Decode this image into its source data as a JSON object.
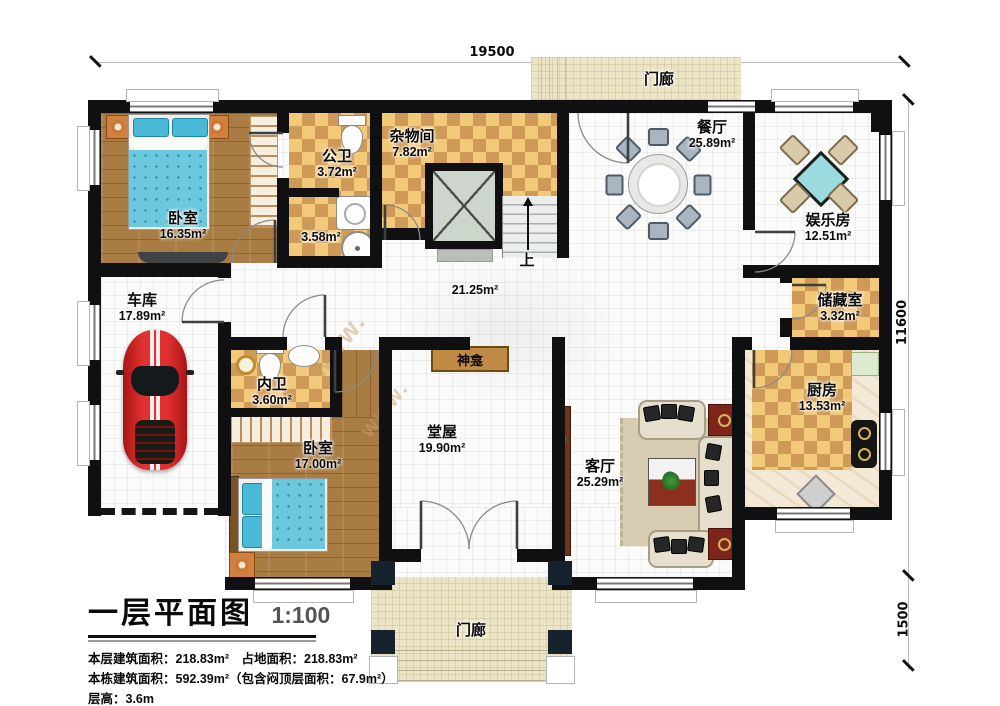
{
  "title_block": {
    "title": "一层平面图",
    "scale": "1:100",
    "info_lines": [
      "本层建筑面积：218.83m²　占地面积：218.83m²",
      "本栋建筑面积：592.39m²（包含闷顶层面积：67.9m²）",
      "层高：3.6m"
    ]
  },
  "dimensions": {
    "width": "19500",
    "height": "11600",
    "porch_depth": "1500"
  },
  "rooms": {
    "porch_top": {
      "name": "门廊"
    },
    "porch_bottom": {
      "name": "门廊"
    },
    "bedroom1": {
      "name": "卧室",
      "area": "16.35m²"
    },
    "public_bath": {
      "name": "公卫",
      "area": "3.72m²"
    },
    "bath_zone": {
      "area": "3.58m²"
    },
    "utility": {
      "name": "杂物间",
      "area": "7.82m²"
    },
    "dining": {
      "name": "餐厅",
      "area": "25.89m²"
    },
    "entertainment": {
      "name": "娱乐房",
      "area": "12.51m²"
    },
    "storage": {
      "name": "储藏室",
      "area": "3.32m²"
    },
    "kitchen": {
      "name": "厨房",
      "area": "13.53m²"
    },
    "garage": {
      "name": "车库",
      "area": "17.89m²"
    },
    "inner_bath": {
      "name": "内卫",
      "area": "3.60m²"
    },
    "bedroom2": {
      "name": "卧室",
      "area": "17.00m²"
    },
    "hall": {
      "area": "21.25m²"
    },
    "main_hall": {
      "name": "堂屋",
      "area": "19.90m²"
    },
    "living": {
      "name": "客厅",
      "area": "25.29m²"
    },
    "shrine": {
      "name": "神龛"
    },
    "stairs_up": {
      "label": "上"
    }
  },
  "watermark": {
    "text": "www."
  },
  "colors": {
    "wall": "#101012",
    "tile_light": "#f2c979",
    "tile_dark": "#cf9a58",
    "wood": "#a87c42",
    "bed": "#6cc8de",
    "car": "#d32222",
    "porch": "#ece4c6",
    "shrine": "#c08b45",
    "pillar": "#16222e"
  }
}
